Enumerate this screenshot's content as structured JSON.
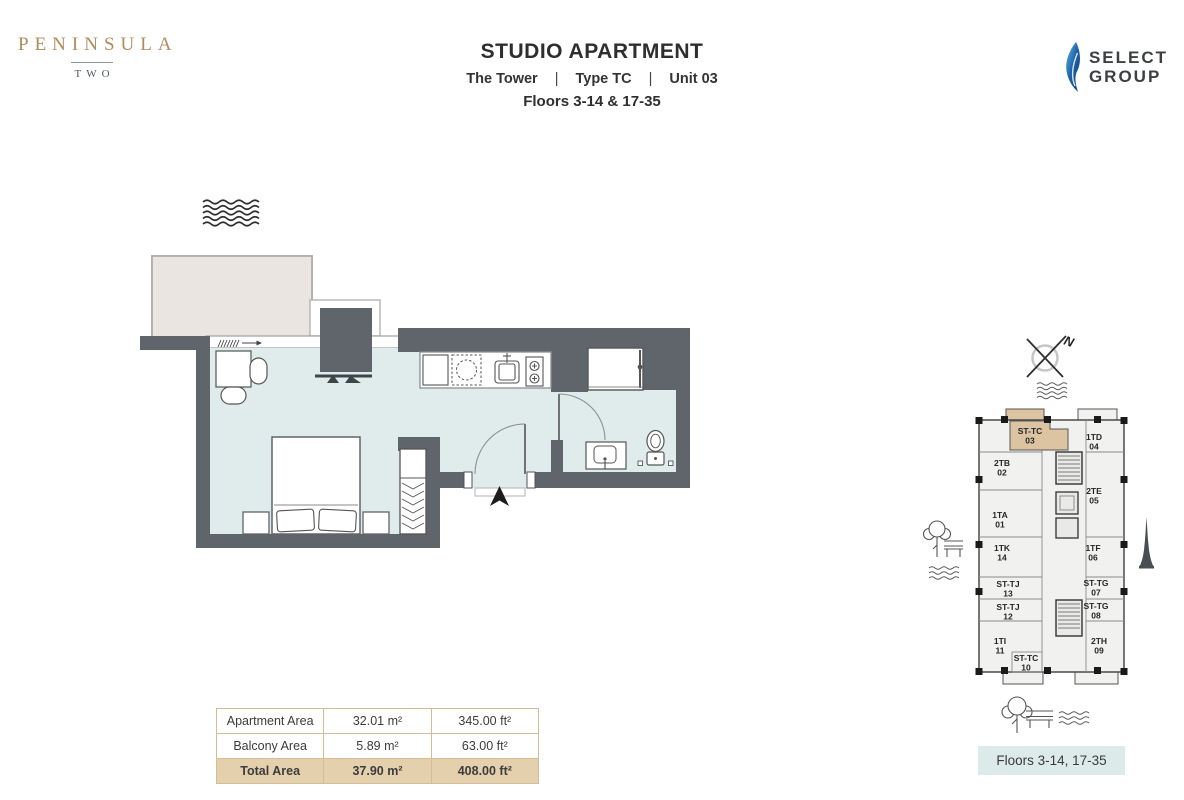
{
  "brand": {
    "name": "PENINSULA",
    "sub": "TWO"
  },
  "header": {
    "title": "STUDIO APARTMENT",
    "tower": "The Tower",
    "sep": "|",
    "type_label": "Type TC",
    "unit_label": "Unit 03",
    "floors_line": "Floors 3-14 & 17-35"
  },
  "developer_logo": {
    "line1": "SELECT",
    "line2": "GROUP"
  },
  "key_plan": {
    "compass_label": "N",
    "floors_box_label": "Floors 3-14, 17-35",
    "units": [
      {
        "code": "ST-TC",
        "num": "03",
        "x": 1030,
        "y": 434,
        "highlight": true
      },
      {
        "code": "1TD",
        "num": "04",
        "x": 1094,
        "y": 440,
        "highlight": false
      },
      {
        "code": "2TB",
        "num": "02",
        "x": 1002,
        "y": 466,
        "highlight": false
      },
      {
        "code": "2TE",
        "num": "05",
        "x": 1094,
        "y": 494,
        "highlight": false
      },
      {
        "code": "1TA",
        "num": "01",
        "x": 1000,
        "y": 518,
        "highlight": false
      },
      {
        "code": "1TK",
        "num": "14",
        "x": 1002,
        "y": 551,
        "highlight": false
      },
      {
        "code": "1TF",
        "num": "06",
        "x": 1093,
        "y": 551,
        "highlight": false
      },
      {
        "code": "ST-TJ",
        "num": "13",
        "x": 1008,
        "y": 587,
        "highlight": false
      },
      {
        "code": "ST-TG",
        "num": "07",
        "x": 1096,
        "y": 586,
        "highlight": false
      },
      {
        "code": "ST-TJ",
        "num": "12",
        "x": 1008,
        "y": 610,
        "highlight": false
      },
      {
        "code": "ST-TG",
        "num": "08",
        "x": 1096,
        "y": 609,
        "highlight": false
      },
      {
        "code": "1TI",
        "num": "11",
        "x": 1000,
        "y": 644,
        "highlight": false
      },
      {
        "code": "ST-TC",
        "num": "10",
        "x": 1026,
        "y": 661,
        "highlight": false
      },
      {
        "code": "2TH",
        "num": "09",
        "x": 1099,
        "y": 644,
        "highlight": false
      }
    ]
  },
  "area_table": {
    "rows": [
      {
        "label": "Apartment Area",
        "m2": "32.01 m²",
        "ft2": "345.00 ft²",
        "total": false
      },
      {
        "label": "Balcony Area",
        "m2": "5.89 m²",
        "ft2": "63.00 ft²",
        "total": false
      },
      {
        "label": "Total Area",
        "m2": "37.90 m²",
        "ft2": "408.00 ft²",
        "total": true
      }
    ]
  },
  "colors": {
    "wall": "#5f656a",
    "floor": "#dfeceb",
    "balcony": "#eae5e0",
    "accent_tan": "#dcc3a1",
    "table_border": "#d2bd98",
    "total_row_bg": "#e5d0ae",
    "floors_box_bg": "#dcebe9",
    "brand_gold": "#b08c5e",
    "brand_two": "#4c5a64",
    "logo_blue": "#1b5fa8"
  }
}
